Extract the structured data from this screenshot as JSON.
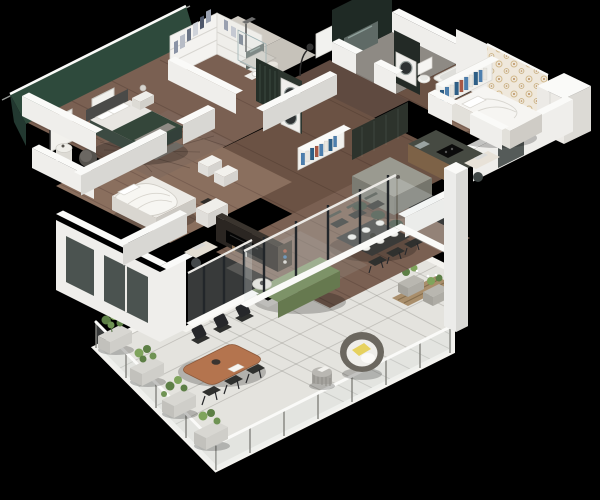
{
  "meta": {
    "description": "3D isometric cutaway floor plan rendering of an apartment with a large tiled terrace, on a black background",
    "background": "#000000",
    "no_visible_text": true
  },
  "palette": {
    "background": "#000000",
    "roofline": "#c9cdc9",
    "wallWhite": "#efeeeb",
    "wallTop": "#fafaf8",
    "wallShade": "#d8d7d3",
    "wallDark": "#c5c4c0",
    "greenWall": "#2e4a3c",
    "greenWallDark": "#223830",
    "hallWall": "#252f28",
    "bathWall": "#1f2a25",
    "mirror": "#5f6a66",
    "wallpaperBase": "#efe8dc",
    "wallpaperDot": "#d2b98c",
    "floorWood": "#7a6052",
    "floorWoodDark": "#5f4a40",
    "floorWoodMid": "#6b5244",
    "floorWoodLight": "#8a6f5e",
    "floorCloset": "#cfcac2",
    "bathFloor": "#8e8a84",
    "showerFloor": "#c6c2ba",
    "terraceTile": "#e4e3de",
    "terraceBorder": "#f4f3ef",
    "glassDark": "#39413f",
    "railPost": "#83837e",
    "sofaGreen": "#7d9368",
    "sofaGreenLight": "#8a9e74",
    "sofaGreenDark": "#66794f",
    "duvetGreen": "#34463a",
    "bedWhite": "#f6f5f2",
    "bedShadeLight": "#e2e0da",
    "bedShade": "#cfccc6",
    "charcoal": "#3a3a38",
    "chairDark": "#2f302e",
    "stoolGreen": "#3d4a3c",
    "islandTop": "#9a9a90",
    "islandSide": "#75756c",
    "counterTop": "#464a42",
    "counterWood": "#7d6247",
    "cooktop": "#0b0b0b",
    "woodTable": "#b4744e",
    "woodDeck": "#a98e6b",
    "planter": "#d8d7d2",
    "planterSide": "#c2c1bc",
    "plantGreen": "#5d7f46",
    "plantLight": "#7fa45c",
    "yellow": "#e6d15e",
    "eggOuter": "#6b675f",
    "eggInner": "#efeeea",
    "tvBlack": "#050505",
    "mediaDark": "#2b2622",
    "bookNavy": "#2e5f86",
    "bookBlue": "#4d7fae",
    "bookWhite": "#e8e6e0",
    "bookRed": "#a85844",
    "lampDark": "#2a2a2a"
  },
  "rooms": [
    {
      "id": "master-bedroom",
      "label": "master bedroom",
      "accent": "dark green feature wall",
      "furniture": [
        "double bed with green duvet and white pillows",
        "upholstered headboard",
        "foot bench",
        "area rug",
        "nightstand with lamp",
        "armchair",
        "drum side table",
        "floor lamp",
        "two wall frames"
      ]
    },
    {
      "id": "walk-in-closet",
      "label": "walk-in closet",
      "furniture": [
        "open wardrobe with hanging clothes and shelves"
      ]
    },
    {
      "id": "shower-room",
      "label": "shower room",
      "furniture": [
        "walk-in shower",
        "corner sink unit",
        "mirror",
        "laundry basket"
      ]
    },
    {
      "id": "entry-hall",
      "label": "entry hall",
      "accent": "dark green panelling",
      "furniture": [
        "stacked washer and dryer",
        "tall cabinets",
        "arc floor lamp",
        "entry door"
      ]
    },
    {
      "id": "bathroom",
      "label": "bathroom",
      "accent": "dark green wall",
      "furniture": [
        "washing machine column",
        "toilet",
        "bathtub",
        "mirror wall"
      ]
    },
    {
      "id": "kids-bedroom",
      "label": "kids bedroom",
      "accent": "floral wallpaper wall",
      "furniture": [
        "single bed with white bedding",
        "tall white wardrobe",
        "desk with laptop",
        "desk chair",
        "bookshelf with colorful books"
      ]
    },
    {
      "id": "second-bedroom",
      "label": "second bedroom",
      "furniture": [
        "double bed with rumpled white duvet",
        "small desk with laptop",
        "desk chair",
        "storage boxes"
      ]
    },
    {
      "id": "kitchen",
      "label": "kitchen",
      "furniture": [
        "dark counter with cooktop and sink",
        "stone-top island",
        "three green bar stools",
        "tall dark cabinet wall"
      ]
    },
    {
      "id": "dining-area",
      "label": "dining area",
      "furniture": [
        "dark dining table set with six plates",
        "six dark chairs"
      ]
    },
    {
      "id": "living-room",
      "label": "living room",
      "furniture": [
        "green sofa with white pillows",
        "round coffee table",
        "media wall with TV",
        "shelf with books",
        "white dresser",
        "area rug",
        "glazed wall to terrace"
      ]
    },
    {
      "id": "terrace",
      "label": "terrace",
      "furniture": [
        "light tile floor",
        "glass railing with posts",
        "row of planters with greenery",
        "wood deck corner with flower planters",
        "oval wood dining table",
        "six dark outdoor chairs",
        "cocoon egg chair with yellow pillow",
        "round side table"
      ]
    }
  ]
}
